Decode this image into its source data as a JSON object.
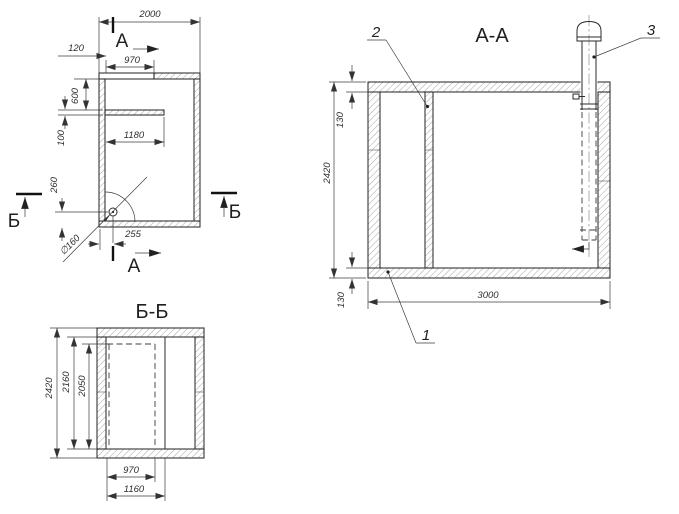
{
  "meta": {
    "background": "#ffffff",
    "line_color": "#2b2b2b",
    "dim_color": "#3c3c3c"
  },
  "plan": {
    "section_a": "А",
    "section_b": "Б",
    "dims": {
      "d2000": "2000",
      "d120": "120",
      "d970": "970",
      "d600": "600",
      "d100": "100",
      "d1180": "1180",
      "d260": "260",
      "d255": "255",
      "dia160": "∅160"
    }
  },
  "section_aa": {
    "title": "А-А",
    "dims": {
      "top_wall": "130",
      "height": "2420",
      "bottom_wall": "130",
      "width": "3000"
    },
    "callouts": {
      "c1": "1",
      "c2": "2",
      "c3": "3"
    }
  },
  "section_bb": {
    "title": "Б-Б",
    "dims": {
      "height": "2420",
      "inner_height": "2160",
      "opening_height": "2050",
      "opening_width": "970",
      "chamber_width": "1160"
    }
  }
}
